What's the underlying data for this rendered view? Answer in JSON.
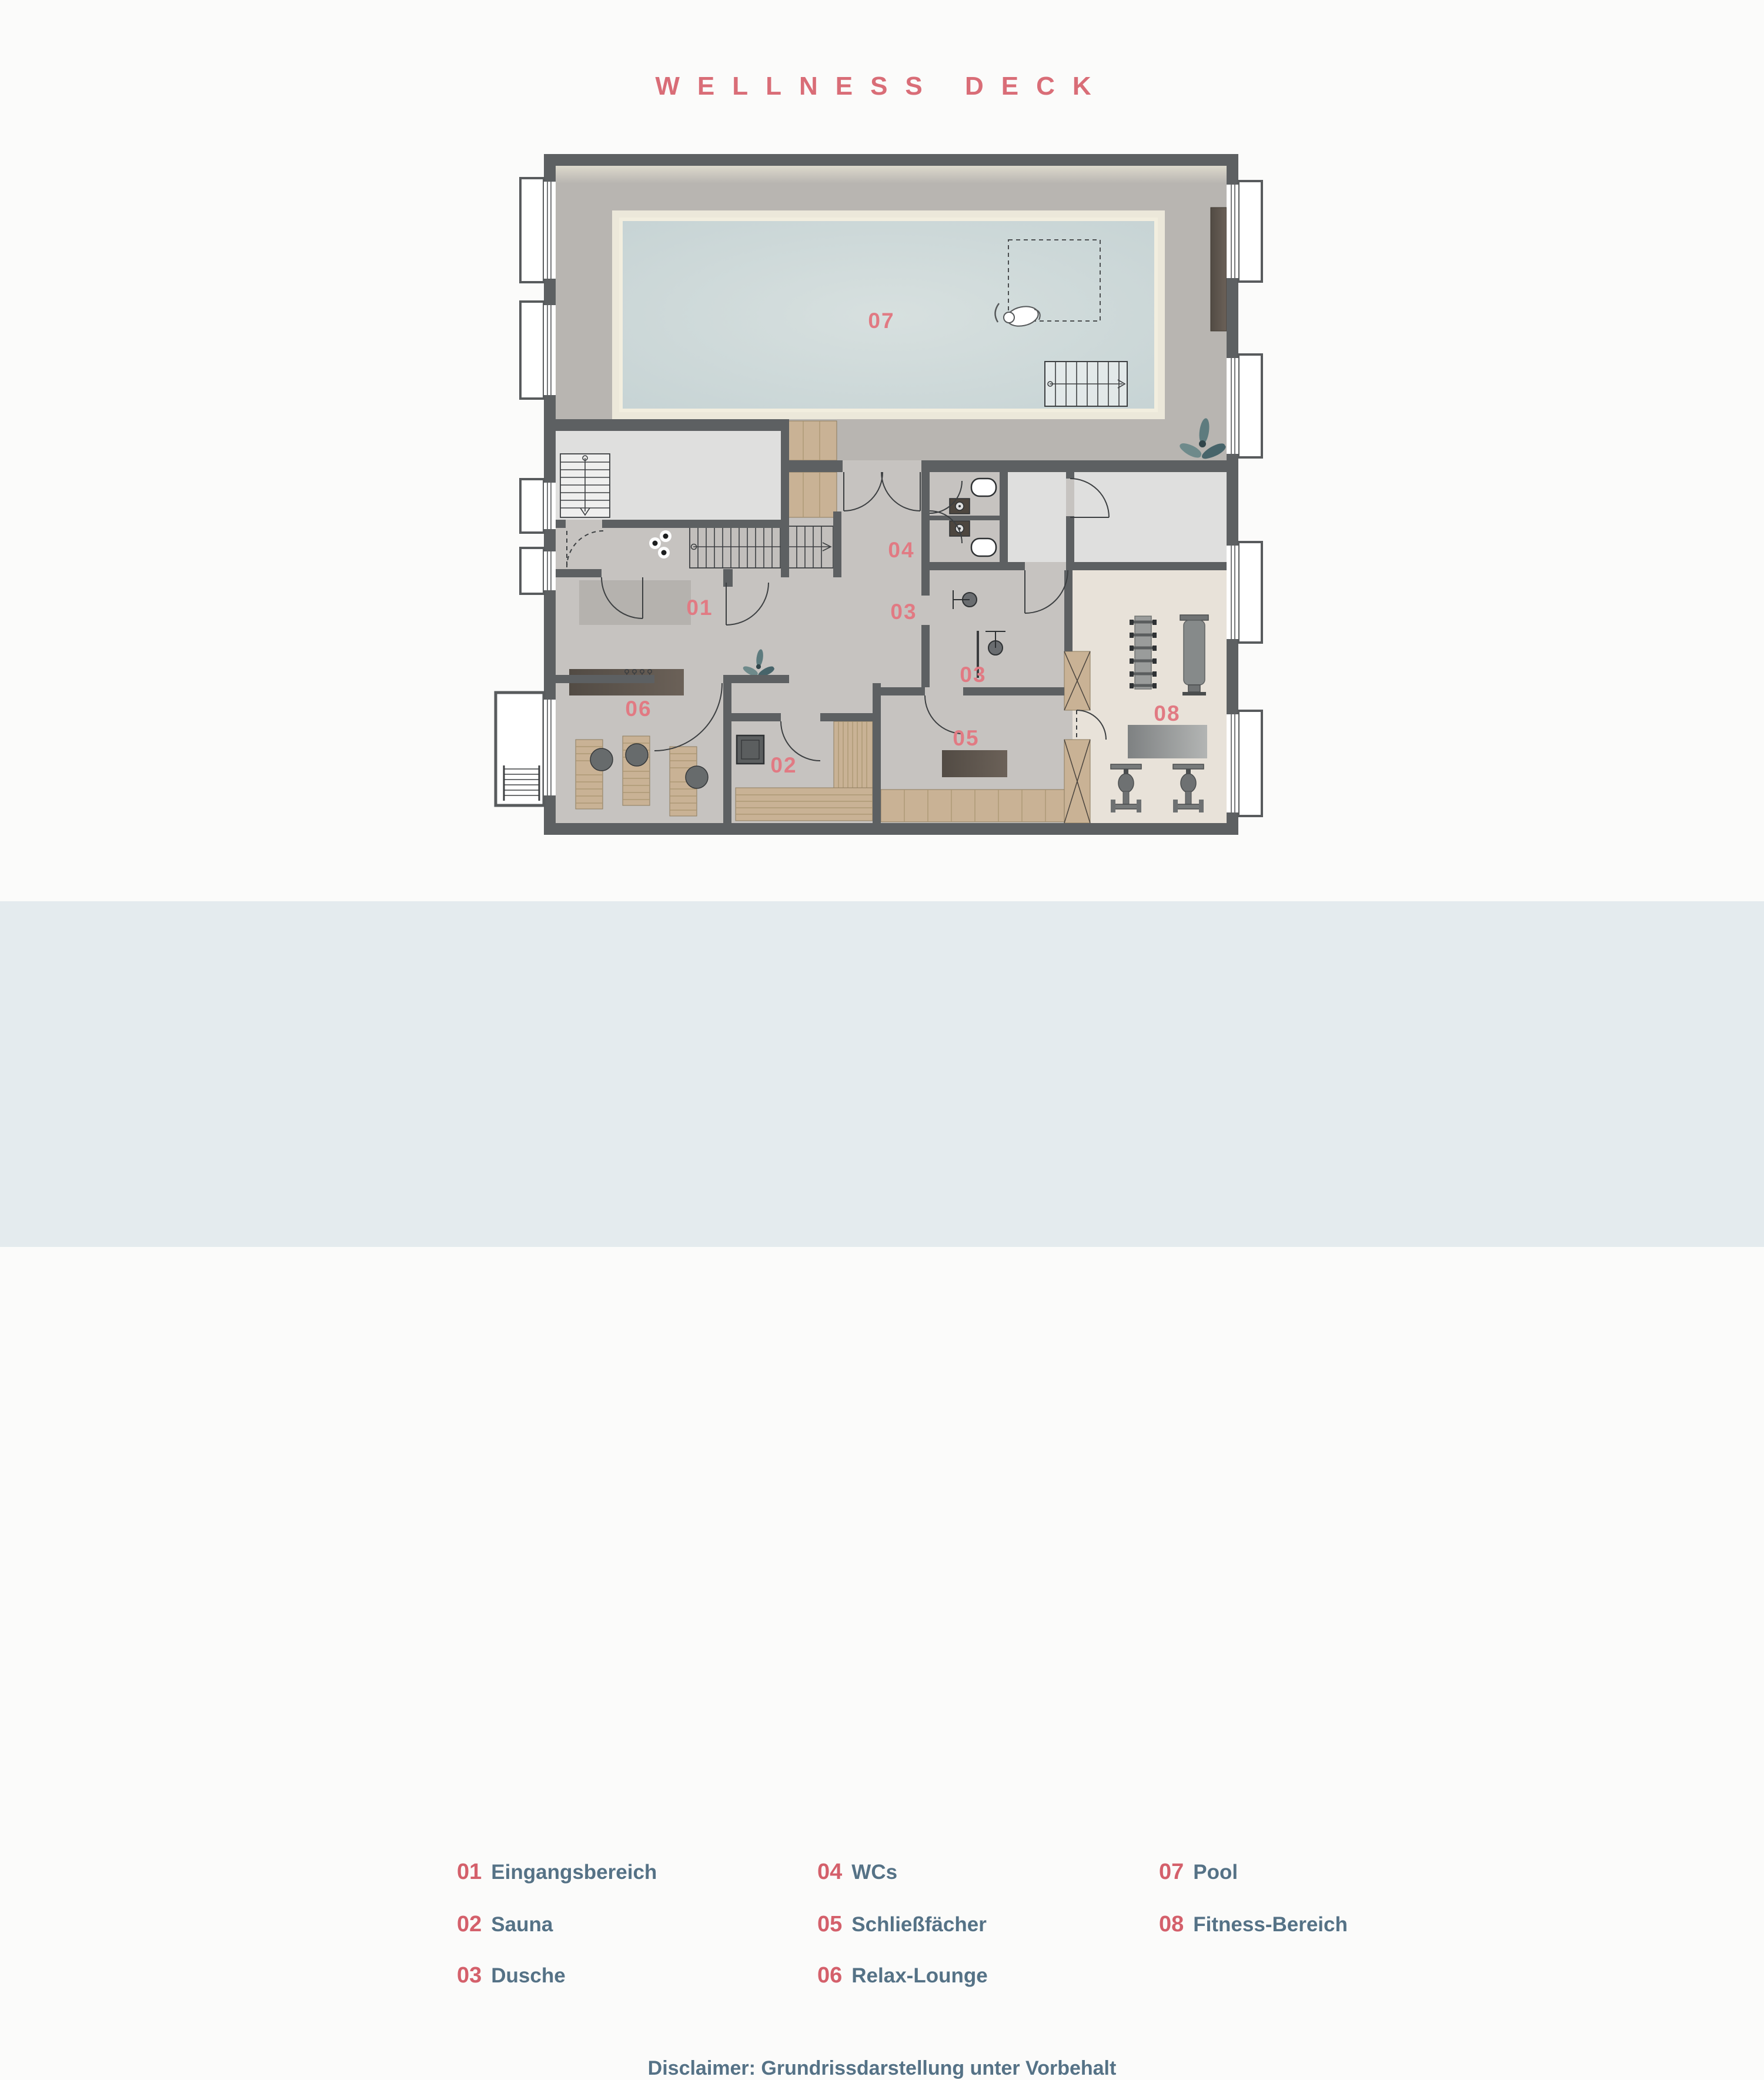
{
  "title": "WELLNESS DECK",
  "legend": {
    "items": [
      {
        "num": "01",
        "label": "Eingangsbereich"
      },
      {
        "num": "02",
        "label": "Sauna"
      },
      {
        "num": "03",
        "label": "Dusche"
      },
      {
        "num": "04",
        "label": "WCs"
      },
      {
        "num": "05",
        "label": "Schließfächer"
      },
      {
        "num": "06",
        "label": "Relax-Lounge"
      },
      {
        "num": "07",
        "label": "Pool"
      },
      {
        "num": "08",
        "label": "Fitness-Bereich"
      }
    ]
  },
  "disclaimer": "Disclaimer: Grundrissdarstellung unter Vorbehalt",
  "plan": {
    "room_labels": [
      {
        "num": "01"
      },
      {
        "num": "02"
      },
      {
        "num": "03"
      },
      {
        "num": "04"
      },
      {
        "num": "05"
      },
      {
        "num": "06"
      },
      {
        "num": "07"
      },
      {
        "num": "08"
      }
    ]
  },
  "colors": {
    "title_accent": "#d96d77",
    "legend_number": "#d4606b",
    "legend_text": "#557286",
    "legend_background": "#e4ebee",
    "wall": "#5d6062",
    "pool_water": "#ccd8d9",
    "pool_surround": "#ece8da",
    "deck": "#b8b5b1",
    "floor": "#c6c3c0",
    "light_room": "#dfdfde",
    "fitness_floor": "#e8e2d9",
    "wood": "#c9b295",
    "dark_furniture": "#57504a",
    "plan_label": "#e17a83"
  }
}
